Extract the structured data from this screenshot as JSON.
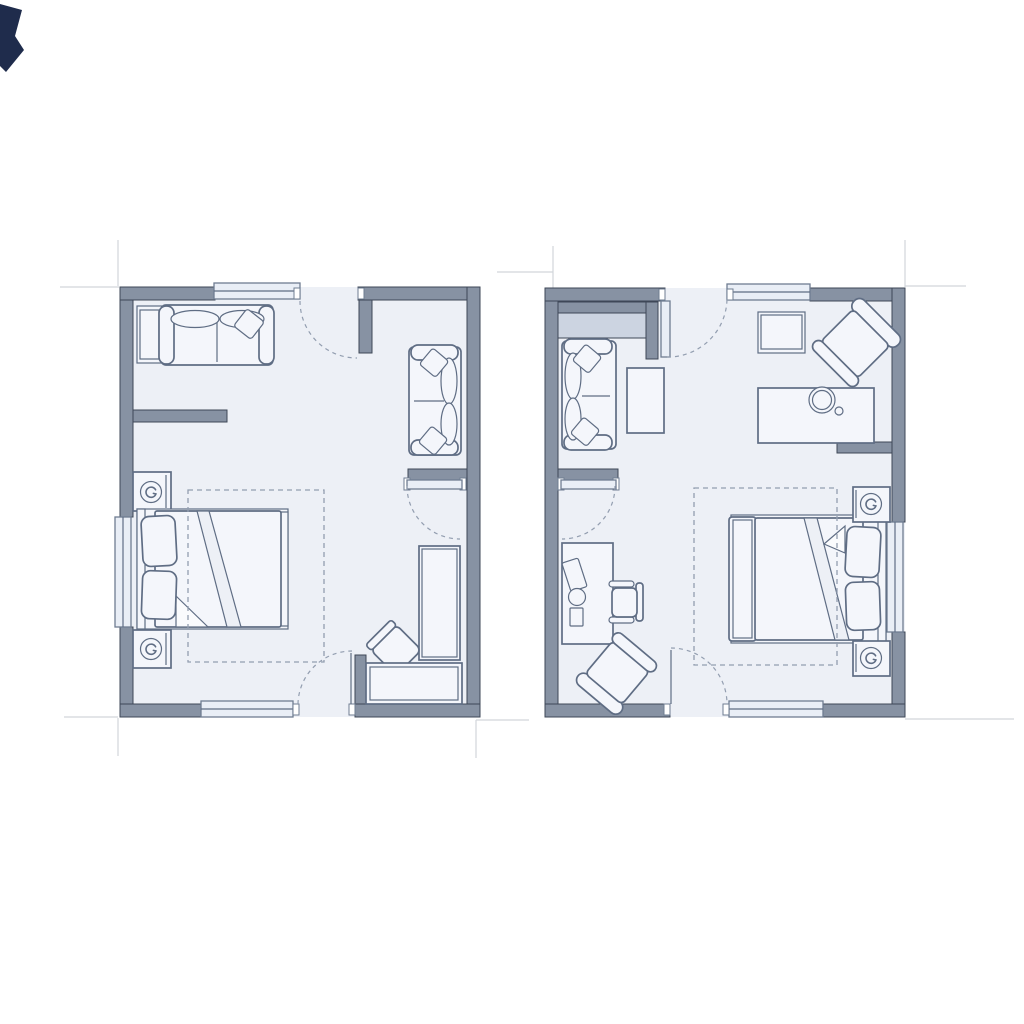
{
  "colors": {
    "background": "#ffffff",
    "wall": "#8792a3",
    "wallStroke": "#3e4757",
    "floor": "#edf0f6",
    "furnFill": "#f4f6fb",
    "furnStroke": "#5f6d84",
    "winFill": "#e9eef6",
    "winStroke": "#6f7d92",
    "dash": "#939eb0",
    "refLine": "#d2d5da",
    "closetFill": "#ccd4e1",
    "artifact": "#1f2c4c"
  },
  "figure": {
    "type": "architectural-floor-plans",
    "plan_count": 2,
    "visible_text": "none"
  },
  "plans": [
    {
      "id": "left-unit",
      "windows": [
        "top-wall-window",
        "left-wall-window",
        "bottom-wall-window"
      ],
      "doors": [
        "top-entry-door-swing",
        "bottom-door-swing",
        "right-closet-door-swing"
      ],
      "furniture": [
        "two-seat-sofa",
        "sofa-side-table",
        "double-bed-with-pillows",
        "nightstand-with-lamp-upper",
        "nightstand-with-lamp-lower",
        "area-rug-outline",
        "right-wall-loveseat",
        "tall-desk-cabinet",
        "swivel-chair",
        "low-counter"
      ]
    },
    {
      "id": "right-unit",
      "windows": [
        "top-wall-window",
        "right-wall-window",
        "bottom-wall-window"
      ],
      "doors": [
        "top-entry-door-swing",
        "bottom-door-swing",
        "left-closet-door-swing"
      ],
      "furniture": [
        "closet-shelf-band",
        "two-seat-sofa",
        "coffee-table",
        "side-table",
        "corner-armchair",
        "vanity-table-with-round-mirror",
        "double-bed-with-pillows",
        "nightstand-with-lamp-upper",
        "nightstand-with-lamp-lower",
        "area-rug-outline",
        "desk-with-accessories",
        "office-chair",
        "lounge-armchair"
      ]
    }
  ]
}
